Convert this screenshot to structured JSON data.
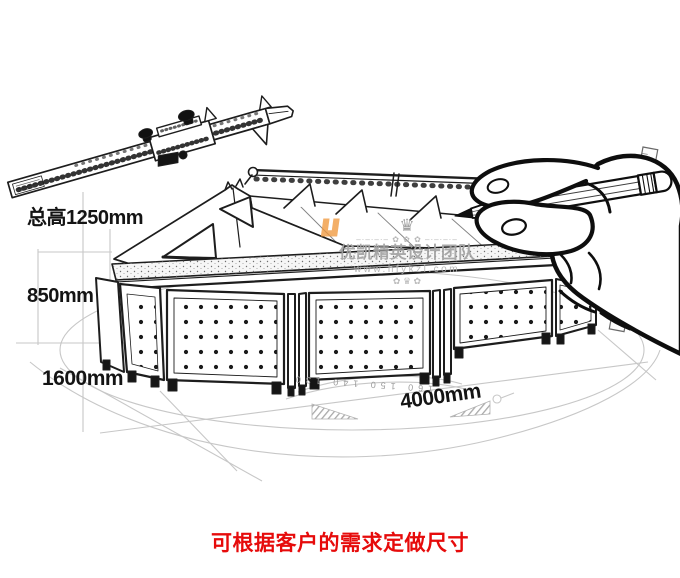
{
  "colors": {
    "ink": "#1d1d1d",
    "guide": "#c7c7c7",
    "watermark": "#a5a5a5",
    "logo": "#f0993e",
    "note": "#e60b0b"
  },
  "dimensions": {
    "total_height": "总高1250mm",
    "base_height": "850mm",
    "depth": "1600mm",
    "length": "4000mm"
  },
  "sketch": {
    "protractor_scale": "160  150  140  130"
  },
  "watermark": {
    "crown": "♛",
    "ornament": "–·–·–·– ✿ ✿ ✿ –·–·–·–",
    "brand": "优凯精英设计团队",
    "website": "www.hfykzl.com",
    "ornament_bottom": "✿ ♛ ✿"
  },
  "footer": {
    "note": "可根据客户的需求定做尺寸"
  }
}
